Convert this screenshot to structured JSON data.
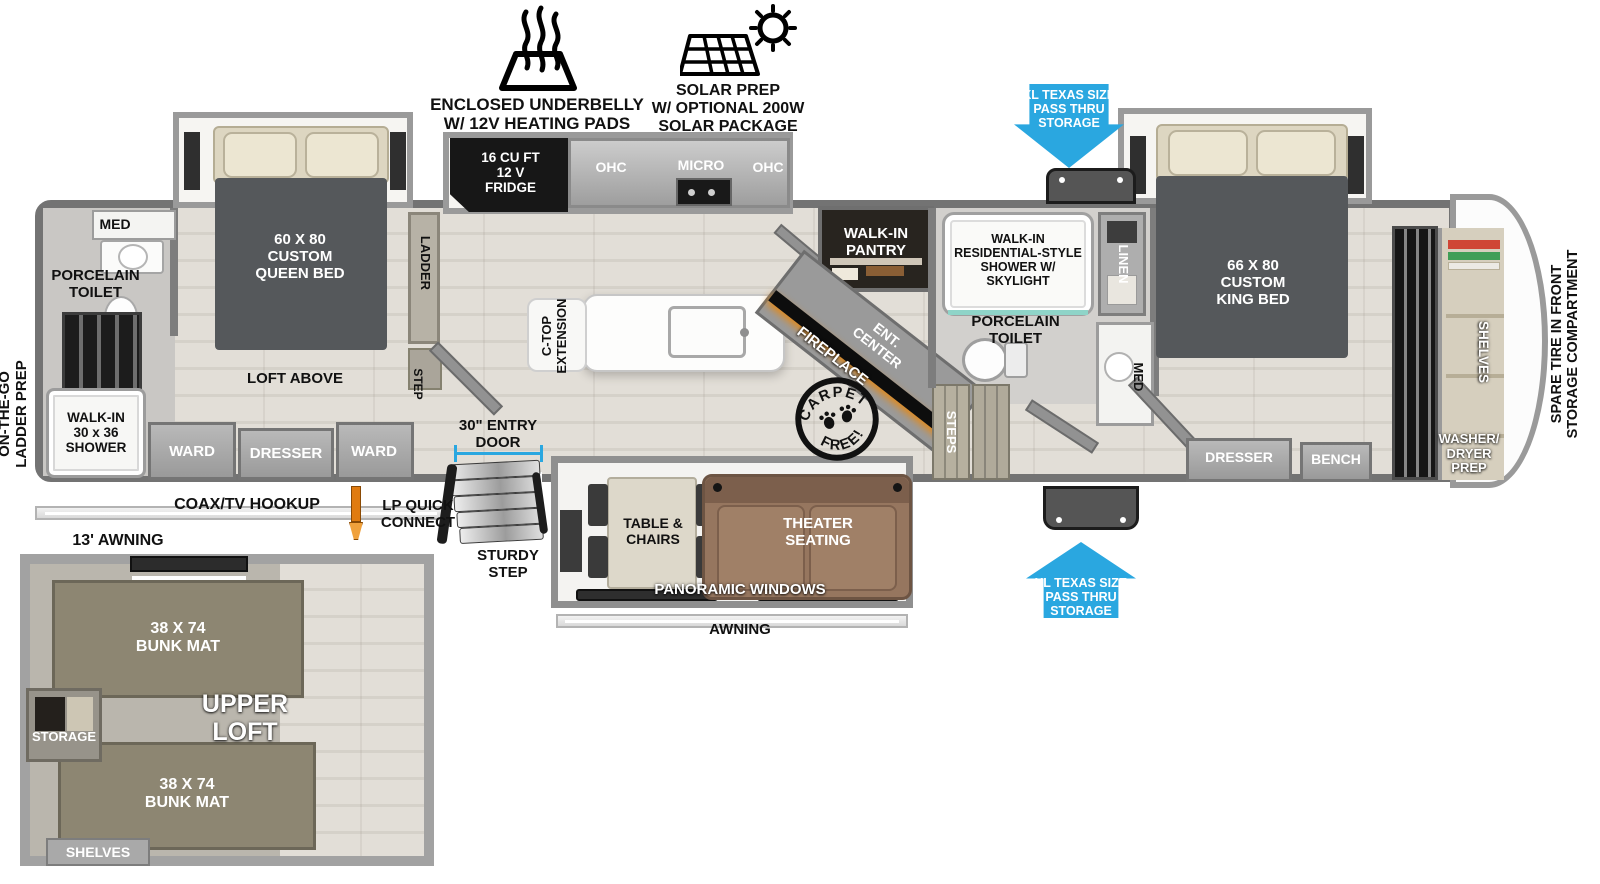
{
  "colors": {
    "arrow_blue": "#2aa7e0",
    "measure_blue": "#2aa7e0",
    "lp_orange": "#e07b10",
    "sofa_brown": "#96765f",
    "bunk_olive": "#8d8672",
    "wall_gray": "#7d7d7d",
    "fridge_black": "#171717",
    "fireplace_glow": "#e08a1e"
  },
  "header": {
    "underbelly": "ENCLOSED UNDERBELLY\nW/ 12V HEATING PADS",
    "solar": "SOLAR PREP\nW/ OPTIONAL 200W\nSOLAR PACKAGE"
  },
  "pass_thru": {
    "top": "XL TEXAS SIZE\nPASS THRU\nSTORAGE",
    "bottom": "XL TEXAS SIZE\nPASS THRU\nSTORAGE"
  },
  "rear_bath": {
    "med": "MED",
    "toilet": "PORCELAIN\nTOILET",
    "shower": "WALK-IN\n30 x 36\nSHOWER",
    "ladder_prep": "ON-THE-GO\nLADDER PREP"
  },
  "front_bedroom": {
    "bed": "60 X  80\nCUSTOM\nQUEEN BED",
    "loft_above": "LOFT ABOVE",
    "ward_left": "WARD",
    "dresser": "DRESSER",
    "ward_right": "WARD",
    "ladder": "LADDER",
    "step": "STEP"
  },
  "kitchen": {
    "fridge": "16 CU FT\n12 V\nFRIDGE",
    "ohc_left": "OHC",
    "micro": "MICRO",
    "ohc_right": "OHC",
    "ctop": "C-TOP\nEXTENSION",
    "entry_door": "30\" ENTRY\nDOOR",
    "sturdy_step": "STURDY\nSTEP"
  },
  "mid": {
    "pantry": "WALK-IN\nPANTRY",
    "ent_center": "ENT.\nCENTER",
    "fireplace": "FIREPLACE",
    "steps": "STEPS",
    "stamp_top": "CARPET",
    "stamp_bottom": "FREE!"
  },
  "main_bath": {
    "shower": "WALK-IN\nRESIDENTIAL-STYLE\nSHOWER W/\nSKYLIGHT",
    "toilet": "PORCELAIN\nTOILET",
    "linen": "LINEN",
    "med": "MED"
  },
  "master_bedroom": {
    "bed": "66 X  80\nCUSTOM\nKING BED",
    "dresser": "DRESSER",
    "bench": "BENCH"
  },
  "front_storage": {
    "shelves": "SHELVES",
    "washer_dryer": "WASHER/\nDRYER\nPREP",
    "spare_tire": "SPARE TIRE IN FRONT\nSTORAGE COMPARTMENT"
  },
  "living": {
    "table": "TABLE &\nCHAIRS",
    "theater": "THEATER\nSEATING",
    "windows": "PANORAMIC WINDOWS",
    "awning": "AWNING"
  },
  "exterior": {
    "coax": "COAX/TV HOOKUP",
    "lp": "LP QUICK\nCONNECT",
    "awning13": "13' AWNING"
  },
  "loft": {
    "bunk_top": "38 X 74\nBUNK MAT",
    "bunk_bottom": "38 X 74\nBUNK MAT",
    "upper_loft": "UPPER\nLOFT",
    "storage": "STORAGE",
    "shelves": "SHELVES"
  }
}
